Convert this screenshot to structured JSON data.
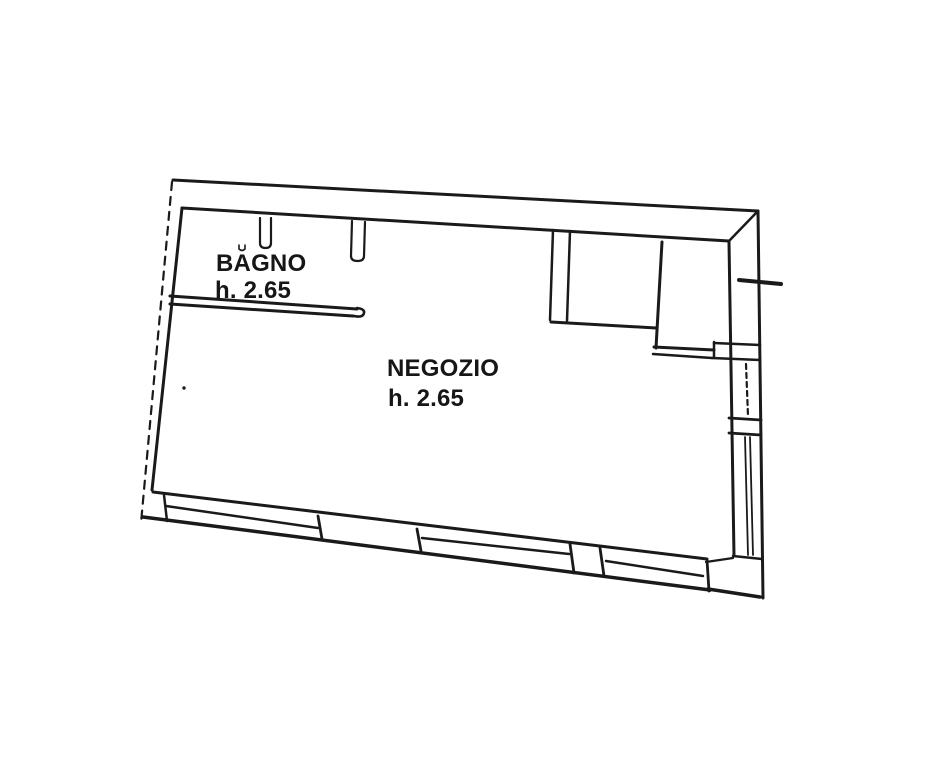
{
  "document": {
    "type": "scanned floor plan",
    "background": "#ffffff",
    "ink": "#1a1a1a"
  },
  "rooms": {
    "bagno": {
      "name": "BAGNO",
      "height_label": "h. 2.65"
    },
    "negozio": {
      "name": "NEGOZIO",
      "height_label": "h. 2.65"
    }
  },
  "plan": {
    "ink": "#1a1a1a",
    "segments": [
      {
        "p": [
          173,
          180,
          758,
          211
        ],
        "w": 3,
        "name": "top-outer-wall"
      },
      {
        "p": [
          758,
          211,
          763,
          598
        ],
        "w": 3,
        "name": "right-outer-wall"
      },
      {
        "p": [
          143,
          517,
          710,
          590
        ],
        "w": 3.5,
        "name": "bottom-outer-wall"
      },
      {
        "p": [
          708,
          589,
          760,
          597
        ],
        "w": 3.5,
        "name": "bottom-outer-corner"
      },
      {
        "p": [
          172,
          182,
          141,
          523
        ],
        "w": 2.2,
        "dash": "8 7",
        "name": "left-boundary-dashed"
      },
      {
        "p": [
          182,
          208,
          152,
          490
        ],
        "w": 3,
        "name": "left-inner-wall"
      },
      {
        "p": [
          182,
          208,
          729,
          241
        ],
        "w": 3,
        "name": "top-inner-wall"
      },
      {
        "p": [
          729,
          241,
          757,
          212
        ],
        "w": 2.5,
        "name": "top-right-diagonal"
      },
      {
        "p": [
          170,
          296,
          357,
          309
        ],
        "w": 3,
        "name": "bagno-wall-top-line"
      },
      {
        "p": [
          170,
          304,
          353,
          316
        ],
        "w": 3,
        "name": "bagno-wall-bottom-line"
      },
      {
        "p": [
          553,
          230,
          550,
          320
        ],
        "w": 2.5,
        "name": "partition-left-line"
      },
      {
        "p": [
          570,
          231,
          567,
          321
        ],
        "w": 2.5,
        "name": "partition-right-line"
      },
      {
        "p": [
          551,
          322,
          656,
          328
        ],
        "w": 3,
        "name": "niche-bottom-wall"
      },
      {
        "p": [
          662,
          242,
          656,
          348
        ],
        "w": 3,
        "name": "closet-left-wall"
      },
      {
        "p": [
          654,
          347,
          714,
          350
        ],
        "w": 3,
        "name": "closet-bottom-line-a"
      },
      {
        "p": [
          653,
          354,
          712,
          358
        ],
        "w": 2.5,
        "name": "closet-bottom-line-b"
      },
      {
        "p": [
          714,
          342,
          714,
          358
        ],
        "w": 2.5,
        "name": "closet-step-vertical"
      },
      {
        "p": [
          714,
          343,
          760,
          345
        ],
        "w": 2.5,
        "name": "right-wall-divider-a"
      },
      {
        "p": [
          712,
          358,
          760,
          360
        ],
        "w": 2.5,
        "name": "right-wall-divider-b"
      },
      {
        "p": [
          729,
          242,
          734,
          556
        ],
        "w": 3,
        "name": "right-inner-wall"
      },
      {
        "p": [
          746,
          364,
          748,
          416
        ],
        "w": 2.2,
        "dash": "5 4",
        "name": "window-a-glazing"
      },
      {
        "p": [
          729,
          418,
          761,
          420
        ],
        "w": 2.8,
        "name": "right-pier-top"
      },
      {
        "p": [
          729,
          433,
          761,
          435
        ],
        "w": 2.8,
        "name": "right-pier-bottom"
      },
      {
        "p": [
          745,
          437,
          748,
          555
        ],
        "w": 1.8,
        "name": "window-b-glazing-1"
      },
      {
        "p": [
          750,
          437,
          753,
          555
        ],
        "w": 1.8,
        "name": "window-b-glazing-2"
      },
      {
        "p": [
          733,
          556,
          762,
          559
        ],
        "w": 2.5,
        "name": "right-wall-bottom-divider"
      },
      {
        "p": [
          739,
          280,
          781,
          284
        ],
        "w": 4,
        "name": "right-wall-tick"
      },
      {
        "p": [
          153,
          492,
          707,
          559
        ],
        "w": 3,
        "name": "bottom-inner-wall"
      },
      {
        "p": [
          164,
          495,
          167,
          521
        ],
        "w": 2.5,
        "name": "storefront-left-jamb"
      },
      {
        "p": [
          166,
          506,
          318,
          528
        ],
        "w": 2.5,
        "name": "storefront-window1-glazing"
      },
      {
        "p": [
          318,
          516,
          322,
          539
        ],
        "w": 2.8,
        "name": "storefront-mullion-1"
      },
      {
        "p": [
          417,
          529,
          421,
          551
        ],
        "w": 2.8,
        "name": "storefront-mullion-2"
      },
      {
        "p": [
          422,
          538,
          569,
          554
        ],
        "w": 2.5,
        "name": "storefront-window2-glazing"
      },
      {
        "p": [
          570,
          544,
          574,
          573
        ],
        "w": 2.8,
        "name": "storefront-pier-left"
      },
      {
        "p": [
          600,
          548,
          604,
          576
        ],
        "w": 2.8,
        "name": "storefront-pier-right"
      },
      {
        "p": [
          606,
          561,
          703,
          576
        ],
        "w": 2.5,
        "name": "storefront-window3-glazing"
      },
      {
        "p": [
          707,
          560,
          709,
          591
        ],
        "w": 2.8,
        "name": "corner-block-vertical"
      },
      {
        "p": [
          706,
          562,
          733,
          558
        ],
        "w": 2.2,
        "name": "corner-block-connector"
      }
    ],
    "paths": [
      {
        "d": "M 260 218 L 260 243 Q 260 248 265.5 248 Q 271 248 271 243 L 271 218",
        "w": 2.2,
        "name": "door-jamb-stub-1"
      },
      {
        "d": "M 352 221 L 351 256 Q 351 261 357.5 261 Q 364 261 364 256 L 365 222",
        "w": 2.2,
        "name": "door-jamb-stub-2"
      },
      {
        "d": "M 357 308 Q 365 309 364 313 Q 363 318 354 316",
        "w": 2.6,
        "name": "bagno-wall-end-cap"
      },
      {
        "d": "M 239 245 L 239 249 Q 242 252 245 249 L 245 245",
        "w": 1.6,
        "name": "scan-artifact-mark"
      }
    ],
    "dots": [
      {
        "x": 184,
        "y": 388,
        "r": 1.7,
        "name": "scan-dot-artifact"
      }
    ]
  }
}
